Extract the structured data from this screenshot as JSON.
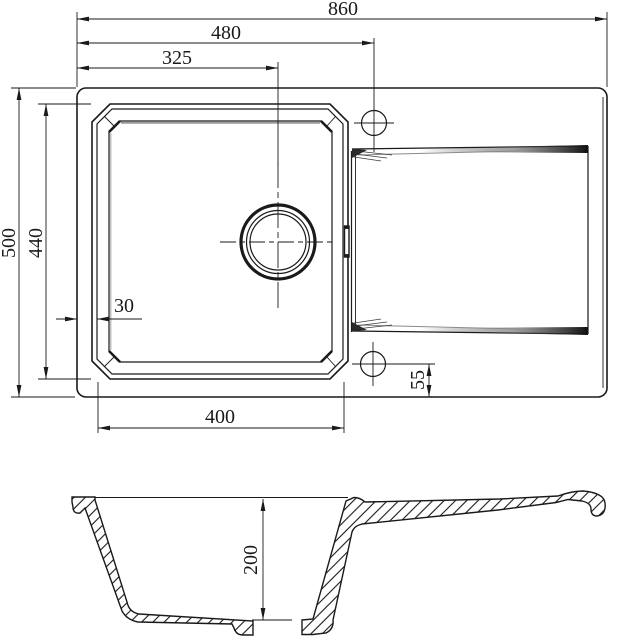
{
  "drawing": {
    "line_color": "#1a1a1a",
    "dimensions": {
      "top_view": {
        "overall_width": "860",
        "tap_hole_from_left": "480",
        "drain_from_left": "325",
        "overall_depth": "500",
        "bowl_outer_depth": "440",
        "rim_to_bowl_offset": "30",
        "bowl_inner_width": "400",
        "tap_hole_to_edge": "55"
      },
      "section_view": {
        "bowl_depth": "200"
      }
    }
  }
}
